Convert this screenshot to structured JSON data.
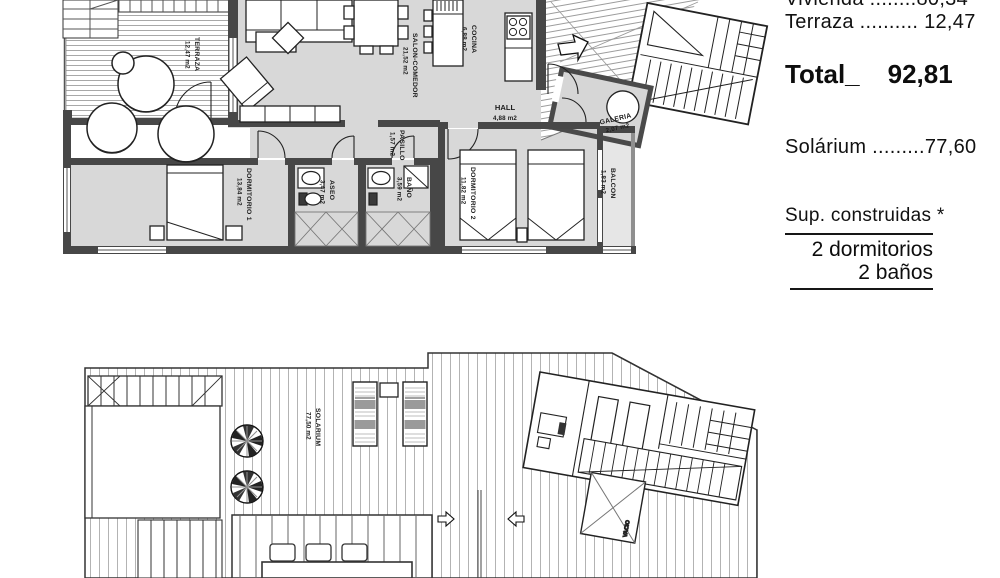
{
  "summary": {
    "vivienda_line": "Vivienda ........80,34",
    "terraza_line": "Terraza .......... 12,47",
    "total_label": "Total_",
    "total_value": "92,81",
    "solarium_line": "Solárium .........77,60",
    "sup_construidas": "Sup. construidas *",
    "bedrooms": "2 dormitorios",
    "bathrooms": "2 baños"
  },
  "plans": {
    "upper": {
      "rooms": [
        {
          "name": "TERRAZA",
          "area": "12,47 m2"
        },
        {
          "name": "SALON-COMEDOR",
          "area": "21,52 m2"
        },
        {
          "name": "COCINA",
          "area": "6,88 m2"
        },
        {
          "name": "HALL",
          "area": "4,88 m2"
        },
        {
          "name": "PASILLO",
          "area": "1,57 m2"
        },
        {
          "name": "GALERIA",
          "area": "2,07 m2"
        },
        {
          "name": "DORMITORIO 1",
          "area": "13,84 m2"
        },
        {
          "name": "ASEO",
          "area": "3,47 m2"
        },
        {
          "name": "BAÑO",
          "area": "3,59 m2"
        },
        {
          "name": "DORMITORIO 2",
          "area": "11,82 m2"
        },
        {
          "name": "BALCON",
          "area": "1,83 m2"
        }
      ]
    },
    "lower": {
      "rooms": [
        {
          "name": "SOLARIUM",
          "area": "77,50 m2"
        },
        {
          "name": "VACIO",
          "area": ""
        }
      ]
    }
  },
  "colors": {
    "wall": "#474747",
    "floor": "#d8d8d8",
    "ink": "#161616"
  }
}
